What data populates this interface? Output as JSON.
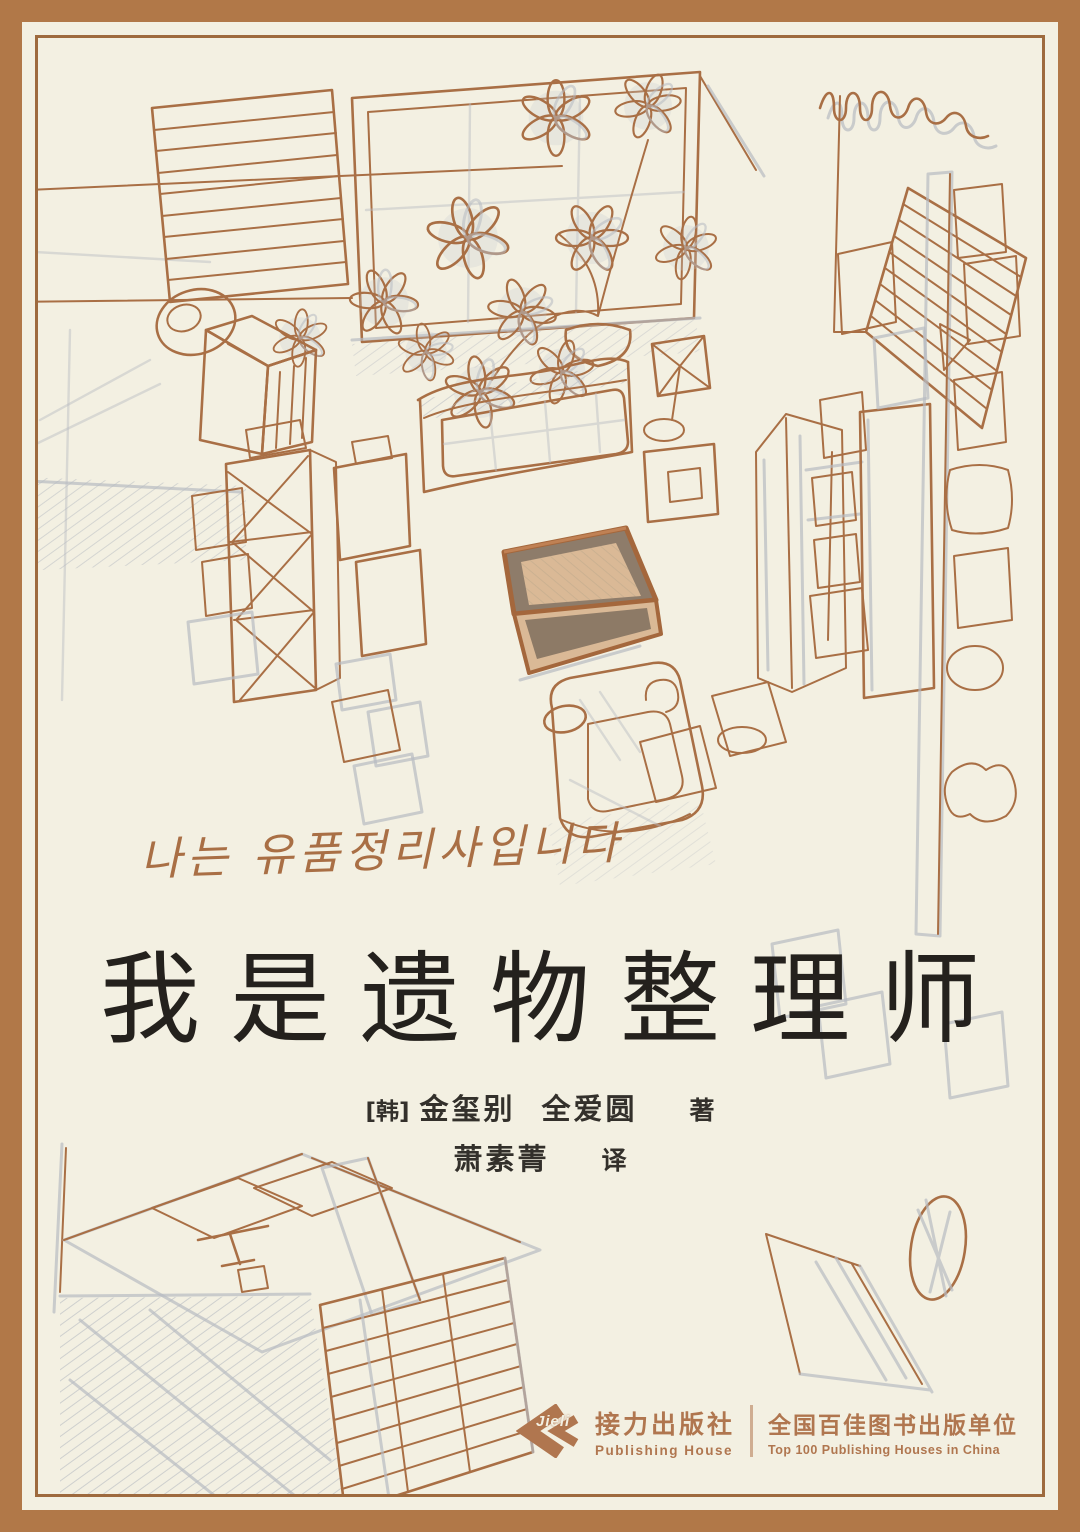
{
  "cover": {
    "korean_tagline": "나는 유품정리사입니다",
    "title": "我是遗物整理师",
    "author": {
      "origin": "[韩]",
      "name1": "金玺别",
      "name2": "全爱圆",
      "role": "著"
    },
    "translator": {
      "name": "萧素菁",
      "role": "译"
    }
  },
  "publisher": {
    "logo_text": "Jieli",
    "name_cn": "接力出版社",
    "name_en": "Publishing House",
    "honor_cn": "全国百佳图书出版单位",
    "honor_en": "Top 100 Publishing Houses in China"
  },
  "illustration": {
    "description": "Hand-drawn bird's-eye sketch of a room: blinds windows, curtain, potted flowering plant, bed, dresser, cross-braced shelf, wall lamp, armchair, wardrobe, dark door, pillar with picture frames, desk with blinds window, rug and oval mirror; a colored open keepsake box sits at the center"
  },
  "colors": {
    "frame_brown": "#b17848",
    "frame_inner_line": "#9e6a3e",
    "background_cream": "#f3f0e2",
    "ink_brown": "#a96f45",
    "pencil_grey": "#b7bbc2",
    "title_black": "#24211d",
    "publisher_terracotta": "#b0764f",
    "box_tan": "#dab996",
    "box_dark": "#8d7a66"
  }
}
